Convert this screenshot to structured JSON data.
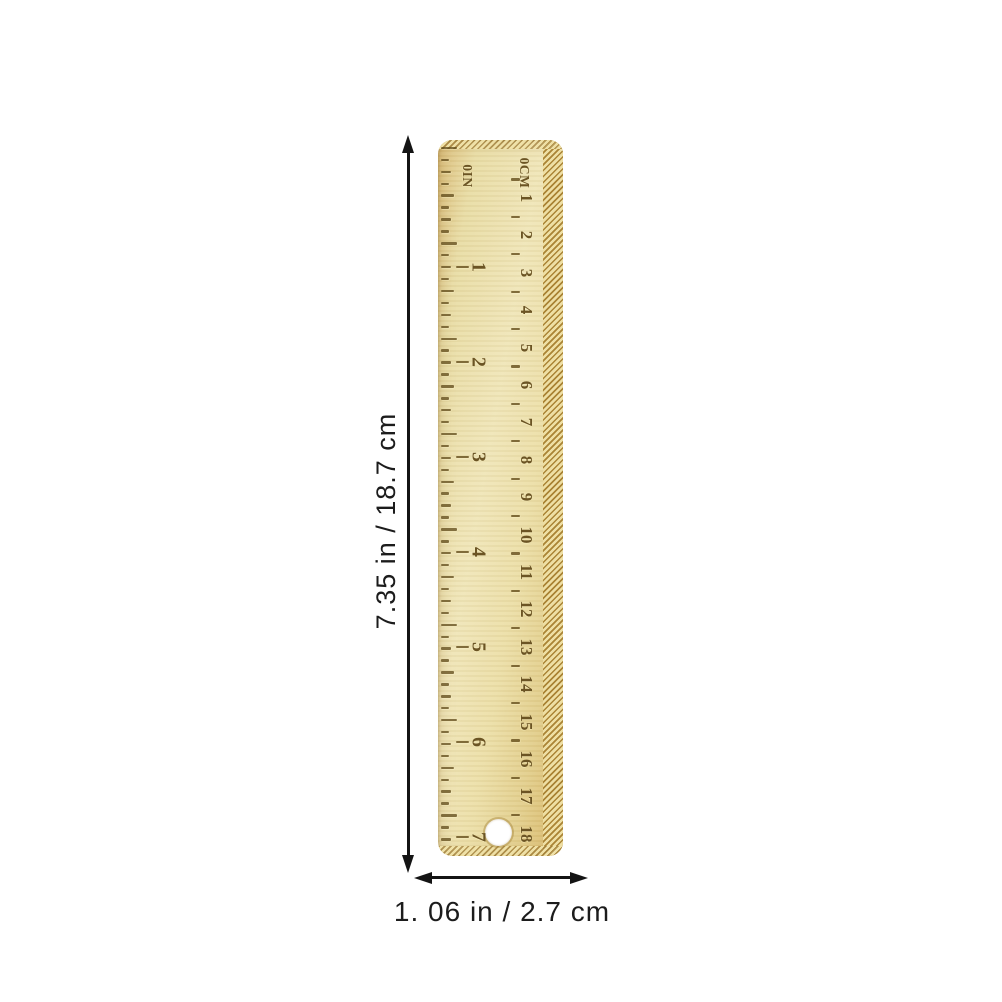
{
  "annotations": {
    "height_label": "7.35 in / 18.7 cm",
    "width_label": "1. 06 in / 2.7 cm"
  },
  "ruler": {
    "inch_zero_label": "0IN",
    "cm_zero_label": "0CM",
    "inch_numbers": [
      "1",
      "2",
      "3",
      "4",
      "5",
      "6",
      "7"
    ],
    "cm_numbers": [
      "1",
      "2",
      "3",
      "4",
      "5",
      "6",
      "7",
      "8",
      "9",
      "10",
      "11",
      "12",
      "13",
      "14",
      "15",
      "16",
      "17",
      "18"
    ]
  },
  "colors": {
    "background": "#ffffff",
    "annotation": "#141414",
    "brass_light": "#f0e6b8",
    "brass_dark": "#d6b465",
    "knurl_gold": "#cfa94f",
    "stamp_ink": "#6b5424"
  }
}
